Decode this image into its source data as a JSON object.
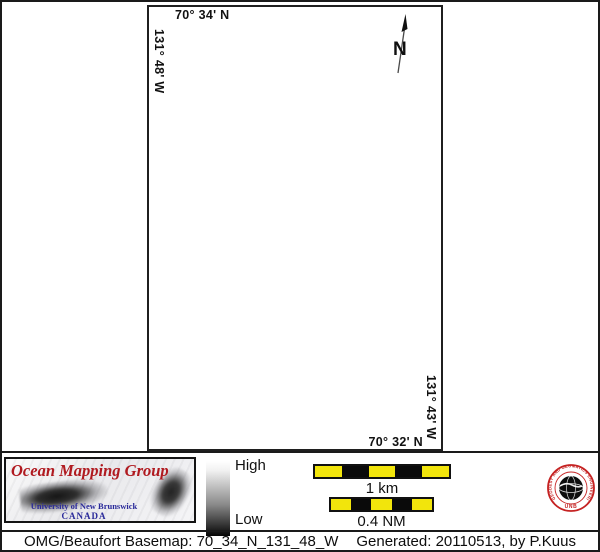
{
  "map": {
    "top_label": "70° 34' N",
    "left_label": "131° 48' W",
    "right_label": "131° 43' W",
    "bottom_label": "70° 32' N",
    "north_label": "N"
  },
  "legend": {
    "high": "High",
    "low": "Low"
  },
  "scalebars": {
    "km_label": "1 km",
    "nm_label": "0.4 NM"
  },
  "logo": {
    "title": "Ocean Mapping Group",
    "subtitle": "University of New Brunswick",
    "country": "CANADA"
  },
  "seal": {
    "ring_text": "GEODESY AND GEOMATICS ENGINEERING",
    "org": "UNB"
  },
  "caption": {
    "basemap": "OMG/Beaufort Basemap: 70_34_N_131_48_W",
    "generated": "Generated: 20110513, by P.Kuus"
  },
  "colors": {
    "scalebar_yellow": "#f2e50c",
    "logo_red": "#b01a20",
    "logo_blue": "#2a2a9a",
    "seal_red": "#c52222",
    "line_black": "#1a1a1a"
  }
}
